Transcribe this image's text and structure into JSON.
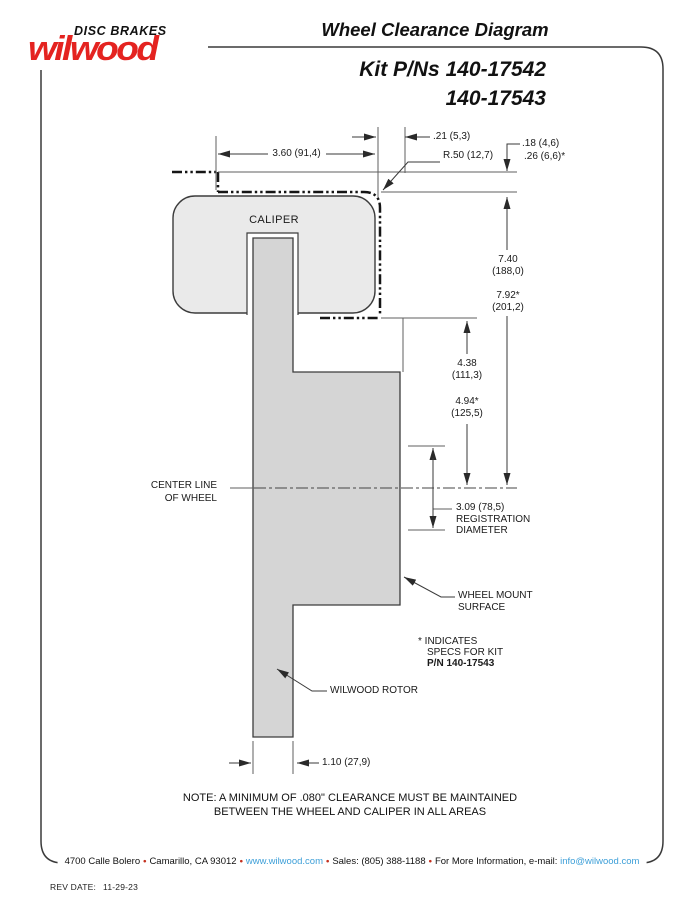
{
  "brand": {
    "name": "wilwood",
    "tagline": "DISC BRAKES"
  },
  "header": {
    "title": "Wheel Clearance Diagram",
    "kit_line1": "Kit P/Ns 140-17542",
    "kit_line2": "140-17543"
  },
  "diagram": {
    "caliper_label": "CALIPER",
    "dim_width": "3.60 (91,4)",
    "dim_lip": ".21 (5,3)",
    "dim_radius": "R.50 (12,7)",
    "dim_clear1": ".18 (4,6)",
    "dim_clear2": ".26 (6,6)*",
    "dim_h1_in": "7.40",
    "dim_h1_mm": "(188,0)",
    "dim_h2_in": "7.92*",
    "dim_h2_mm": "(201,2)",
    "dim_m1_in": "4.38",
    "dim_m1_mm": "(111,3)",
    "dim_m2_in": "4.94*",
    "dim_m2_mm": "(125,5)",
    "centerline_1": "CENTER LINE",
    "centerline_2": "OF WHEEL",
    "reg_dim": "3.09 (78,5)",
    "reg_l2": "REGISTRATION",
    "reg_l3": "DIAMETER",
    "wms_1": "WHEEL MOUNT",
    "wms_2": "SURFACE",
    "star_1": "* INDICATES",
    "star_2": "SPECS FOR KIT",
    "star_3": "P/N 140-17543",
    "rotor_label": "WILWOOD ROTOR",
    "dim_rotor": "1.10 (27,9)"
  },
  "note": {
    "line1": "NOTE: A MINIMUM OF .080\" CLEARANCE MUST BE MAINTAINED",
    "line2": "BETWEEN THE WHEEL AND CALIPER IN ALL AREAS"
  },
  "footer": {
    "address": "4700 Calle Bolero",
    "city": "Camarillo, CA 93012",
    "url": "www.wilwood.com",
    "sales": "Sales: (805) 388-1188",
    "info": "For More Information, e-mail:",
    "email": "info@wilwood.com",
    "bullet": "•"
  },
  "revision": {
    "label": "REV DATE:",
    "date": "11-29-23"
  },
  "colors": {
    "brand_red": "#e42320",
    "link_blue": "#3d9fd8",
    "bullet_red": "#c4311f",
    "caliper_fill": "#eaeaea",
    "rotor_fill": "#d5d5d5"
  }
}
